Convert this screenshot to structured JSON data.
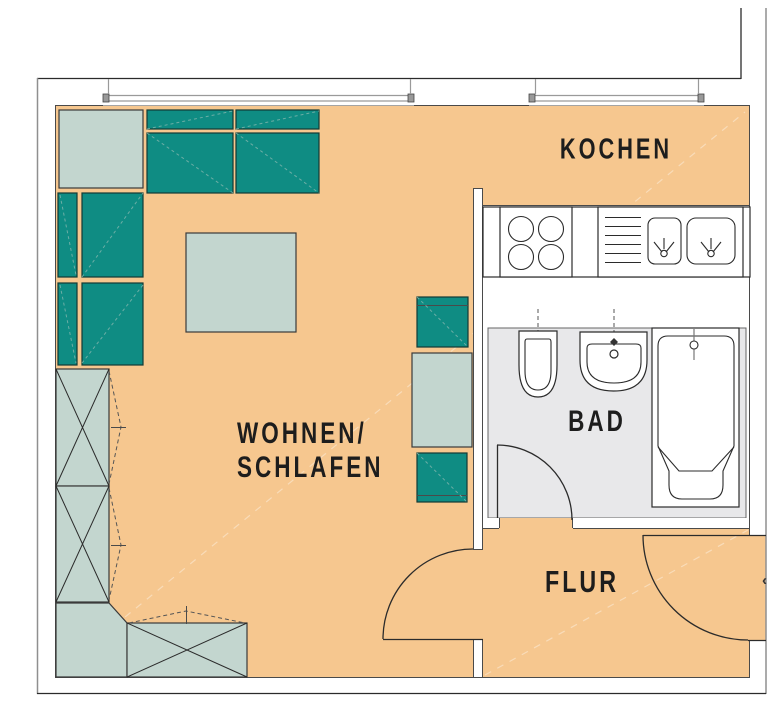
{
  "rooms": {
    "kitchen": {
      "label": "KOCHEN"
    },
    "living_sleeping": {
      "label_line1": "WOHNEN/",
      "label_line2": "SCHLAFEN"
    },
    "bathroom": {
      "label": "BAD"
    },
    "hallway": {
      "label": "FLUR"
    }
  },
  "markers": {
    "entry_direction": "‹"
  },
  "colors": {
    "floor": "#f6c78f",
    "upholstery_teal": "#0f8c83",
    "furniture_light": "#c3d6cf",
    "bathroom_floor": "#e8e8ea",
    "wall": "#ffffff",
    "outline": "#2b2b2b",
    "outer_line_gray": "#8f8f8f",
    "label_text": "#1d1d1d"
  }
}
